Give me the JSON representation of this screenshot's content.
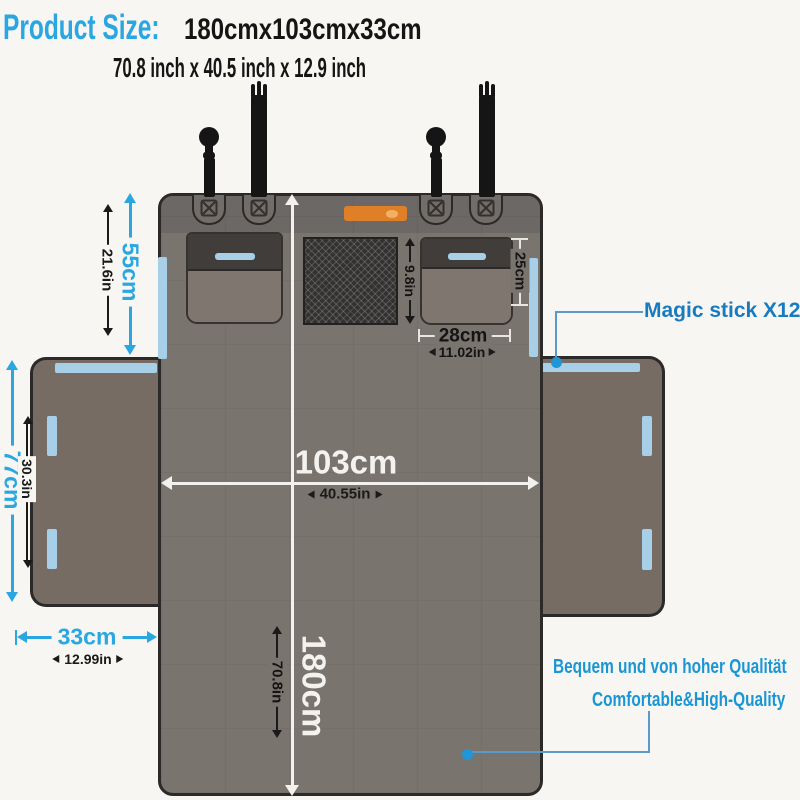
{
  "header": {
    "title": "Product Size:",
    "size_cm": "180cmx103cmx33cm",
    "size_inch": "70.8 inch x 40.5 inch x 12.9 inch"
  },
  "dims": {
    "top_section_cm": "55cm",
    "top_section_in": "21.6in",
    "side_flap_height_cm": "77cm",
    "side_flap_height_in": "30.3in",
    "side_flap_width_cm": "33cm",
    "side_flap_width_in": "12.99in",
    "width_cm": "103cm",
    "width_in": "40.55in",
    "length_cm": "180cm",
    "length_in": "70.8in",
    "mesh_pocket_in": "9.8in",
    "pocket_height_cm": "25cm",
    "pocket_width_cm": "28cm",
    "pocket_width_in": "11.02in"
  },
  "callouts": {
    "magic_stick": "Magic stick X12",
    "quality_de": "Bequem und von hoher Qualität",
    "quality_en": "Comfortable&High-Quality"
  },
  "colors": {
    "accent_blue": "#2aa7e0",
    "magic_stick_blue": "#187bc0",
    "quality_blue": "#1b96d5",
    "velcro_blue": "#a8cfe8",
    "panel_gray": "#7a746e",
    "flap_brown": "#766c64",
    "logo_orange": "#df7f28"
  }
}
